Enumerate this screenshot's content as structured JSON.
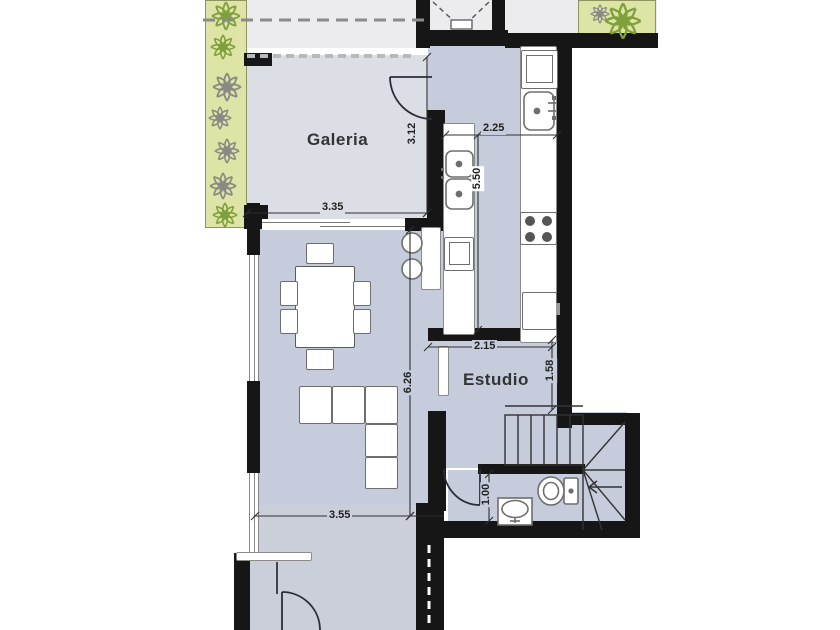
{
  "title": "Apartment floor plan",
  "rooms": {
    "galeria": "Galeria",
    "estudio": "Estudio"
  },
  "dimensions": {
    "galeria_width": "3.35",
    "galeria_depth": "3.12",
    "kitchen_width": "2.25",
    "kitchen_depth": "5.50",
    "living_depth": "6.26",
    "living_width": "3.55",
    "estudio_width": "2.15",
    "estudio_depth": "1.58",
    "bath_depth": "1.00"
  },
  "colors": {
    "wall": "#161616",
    "galeria_floor": "#dcdee6",
    "interior_floor": "#c6ccdc",
    "entry_floor": "#cacfda",
    "outdoor": "#ececef",
    "planter_green": "#dde4a5",
    "plant_gray": "#8a8a84",
    "plant_green": "#7fa03c",
    "line": "#2f2f2f"
  },
  "icons": {
    "plant": "flower-outline",
    "stair_arrow": "left-arrow",
    "toilet": "toilet-plan-symbol",
    "washbasin": "basin-plan-symbol"
  }
}
